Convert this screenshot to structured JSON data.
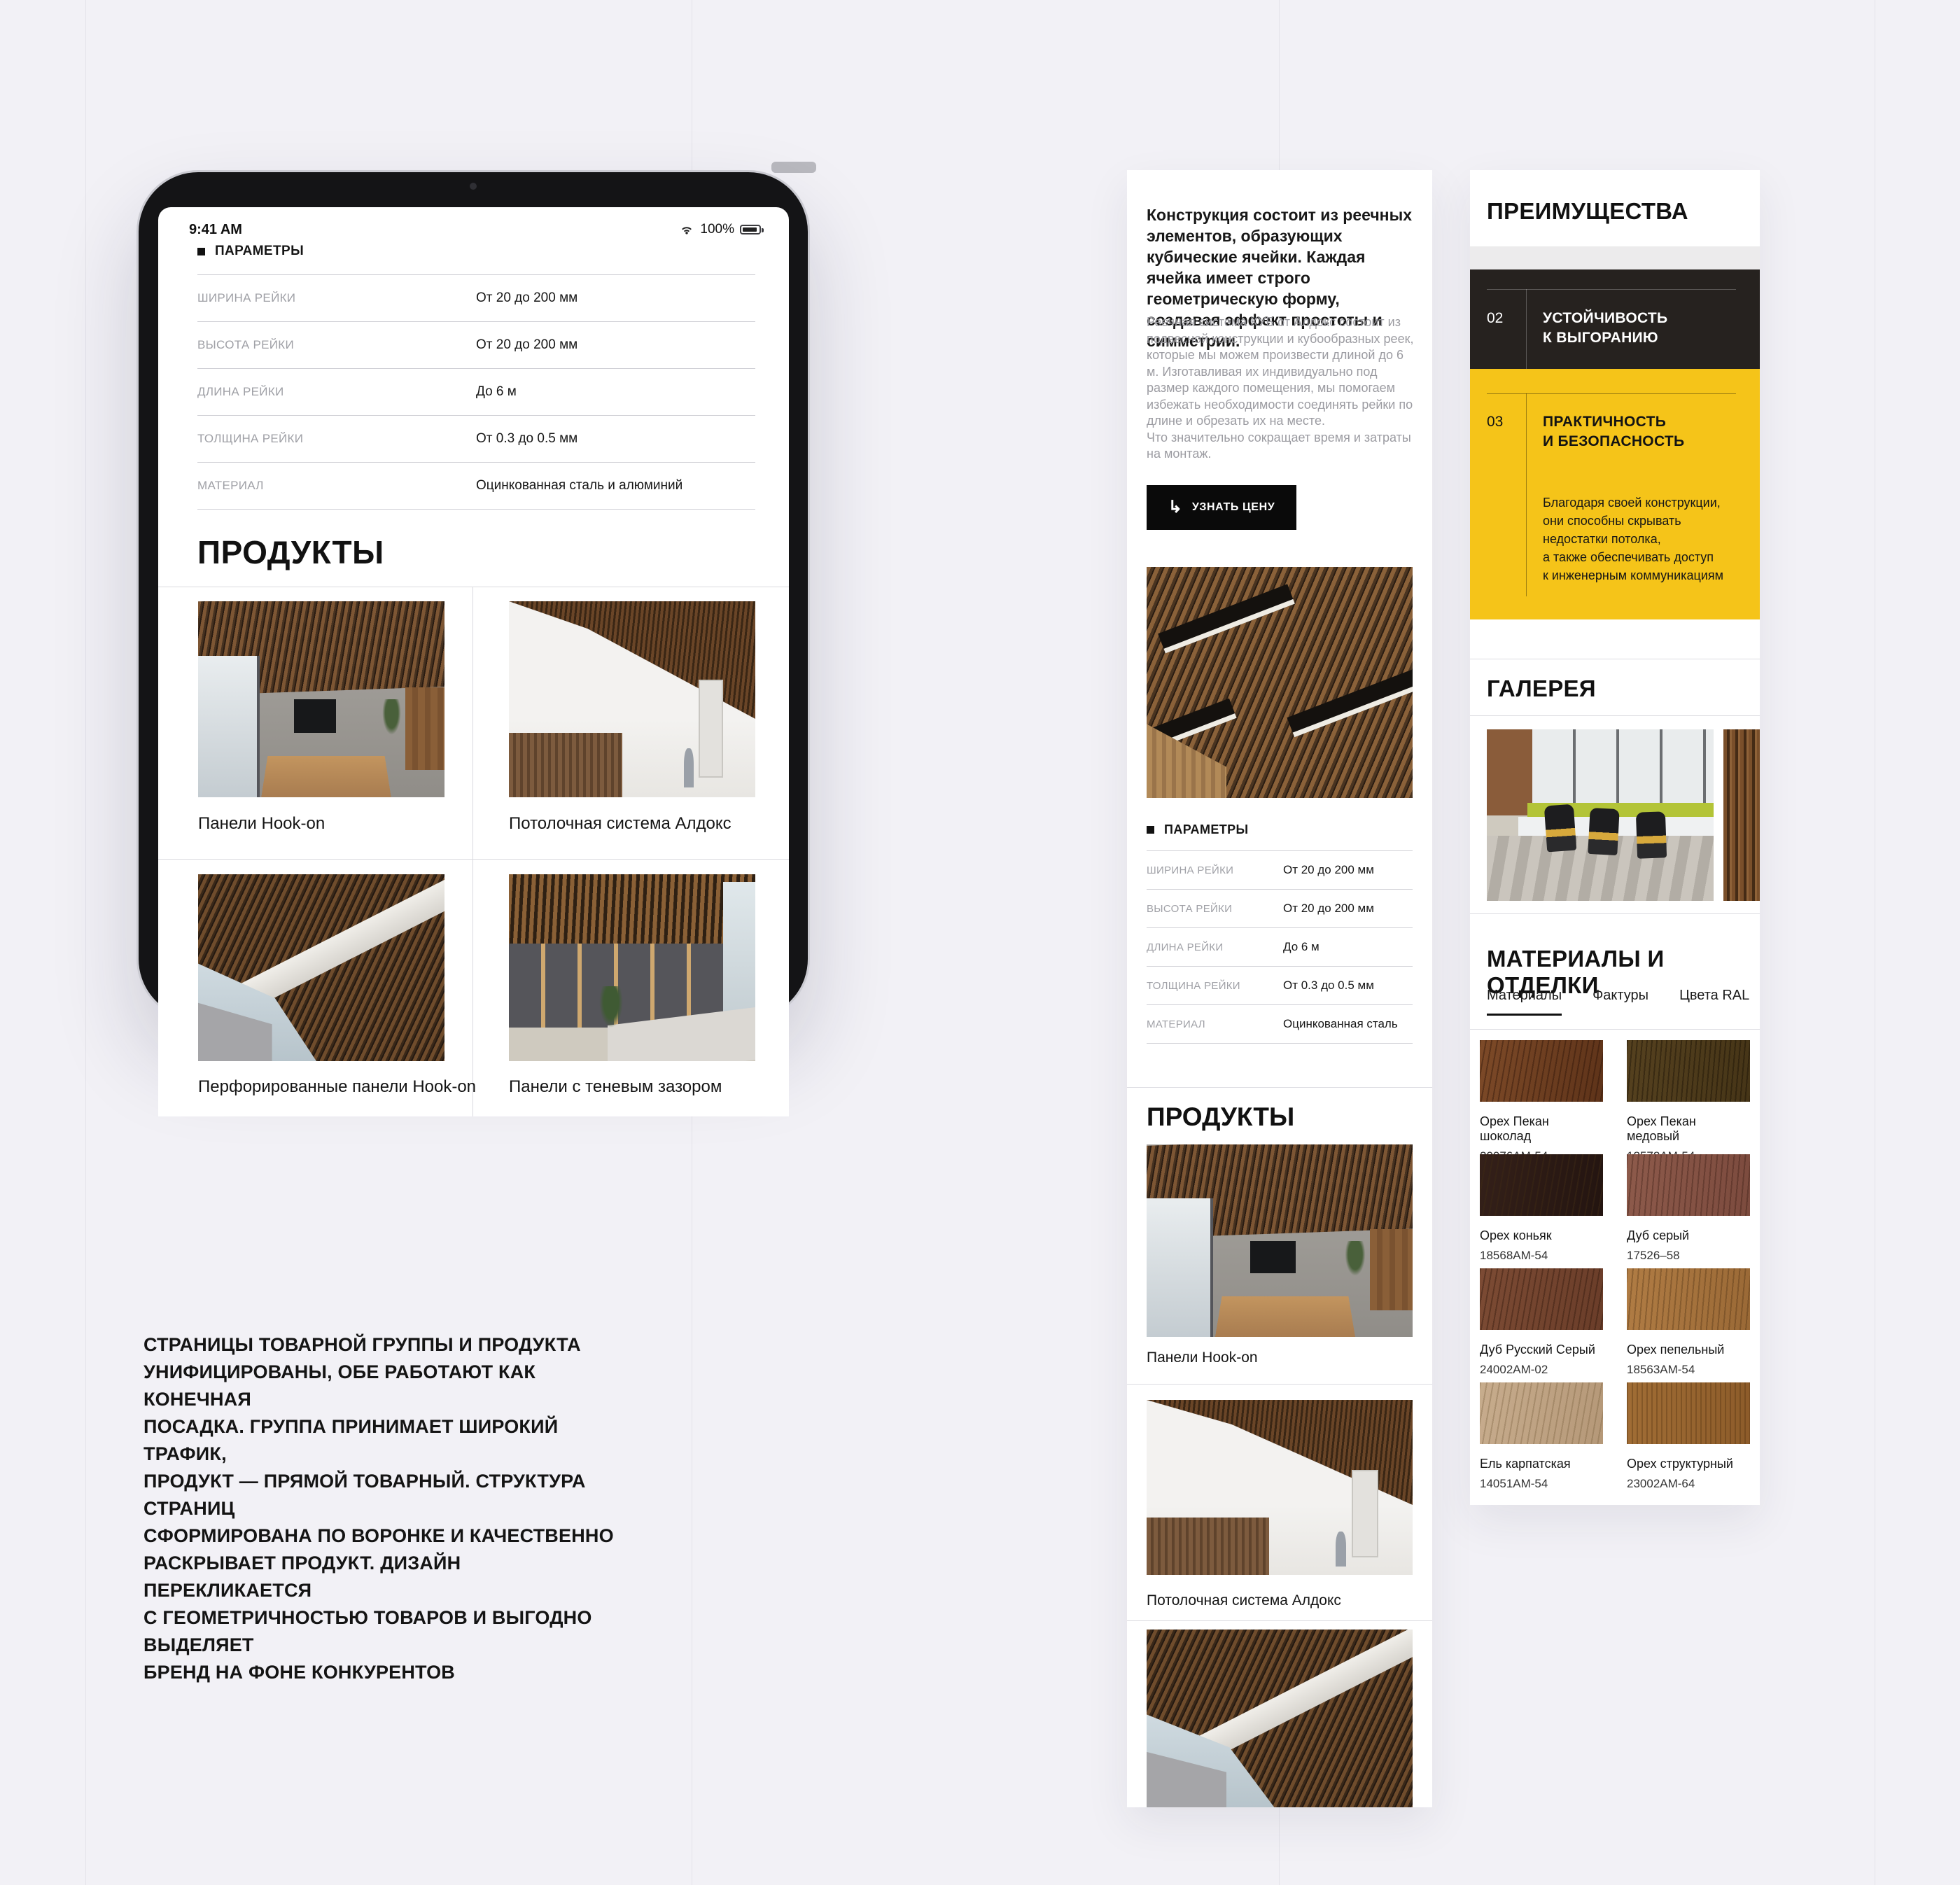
{
  "page": {
    "caption": "СТРАНИЦЫ ТОВАРНОЙ ГРУППЫ И ПРОДУКТА\nУНИФИЦИРОВАНЫ, ОБЕ РАБОТАЮТ КАК КОНЕЧНАЯ\nПОСАДКА. ГРУППА ПРИНИМАЕТ ШИРОКИЙ ТРАФИК,\nПРОДУКТ — ПРЯМОЙ ТОВАРНЫЙ. СТРУКТУРА СТРАНИЦ\nСФОРМИРОВАНА ПО ВОРОНКЕ И КАЧЕСТВЕННО\nРАСКРЫВАЕТ ПРОДУКТ. ДИЗАЙН ПЕРЕКЛИКАЕТСЯ\nС ГЕОМЕТРИЧНОСТЬЮ ТОВАРОВ И ВЫГОДНО ВЫДЕЛЯЕТ\nБРЕНД НА ФОНЕ КОНКУРЕНТОВ"
  },
  "tablet": {
    "status_time": "9:41 AM",
    "status_battery": "100%",
    "params_header": "ПАРАМЕТРЫ",
    "params_rows": [
      {
        "label": "ШИРИНА РЕЙКИ",
        "value": "От 20 до 200 мм"
      },
      {
        "label": "ВЫСОТА РЕЙКИ",
        "value": "От 20 до 200 мм"
      },
      {
        "label": "ДЛИНА РЕЙКИ",
        "value": "До 6 м"
      },
      {
        "label": "ТОЛЩИНА РЕЙКИ",
        "value": "От 0.3 до 0.5 мм"
      },
      {
        "label": "МАТЕРИАЛ",
        "value": "Оцинкованная сталь и алюминий"
      }
    ],
    "products_title": "ПРОДУКТЫ",
    "products": [
      {
        "label": "Панели Hook-on"
      },
      {
        "label": "Потолочная система Алдокс"
      },
      {
        "label": "Перфорированные панели Hook-on"
      },
      {
        "label": "Панели с теневым зазором"
      }
    ]
  },
  "mobile": {
    "intro": "Конструкция состоит из реечных элементов, образующих кубические ячейки. Каждая ячейка имеет строго геометрическую форму, создавая эффект простоты и симметрии.",
    "body": "Реечная система КУБ от Алдокс состоит из подвесной конструкции и кубообразных реек, которые мы можем произвести длиной до 6 м. Изготавливая их индивидуально под размер каждого помещения, мы помогаем избежать необходимости соединять рейки по длине и обрезать их на месте.\nЧто значительно сокращает время и затраты на монтаж.",
    "cta_label": "УЗНАТЬ ЦЕНУ",
    "cta_arrow": "↳",
    "params_header": "ПАРАМЕТРЫ",
    "params_rows": [
      {
        "label": "ШИРИНА РЕЙКИ",
        "value": "От 20 до 200 мм"
      },
      {
        "label": "ВЫСОТА РЕЙКИ",
        "value": "От 20 до 200 мм"
      },
      {
        "label": "ДЛИНА РЕЙКИ",
        "value": "До 6 м"
      },
      {
        "label": "ТОЛЩИНА РЕЙКИ",
        "value": "От 0.3 до 0.5 мм"
      },
      {
        "label": "МАТЕРИАЛ",
        "value": "Оцинкованная сталь"
      }
    ],
    "products_title": "ПРОДУКТЫ",
    "products": [
      {
        "label": "Панели Hook-on"
      },
      {
        "label": "Потолочная система Алдокс"
      }
    ]
  },
  "panel": {
    "advantages_title": "ПРЕИМУЩЕСТВА",
    "advantages": [
      {
        "num": "02",
        "title": "УСТОЙЧИВОСТЬ\nК ВЫГОРАНИЮ"
      },
      {
        "num": "03",
        "title": "ПРАКТИЧНОСТЬ\nИ БЕЗОПАСНОСТЬ",
        "text": "Благодаря своей конструкции,\nони способны скрывать\nнедостатки потолка,\nа также обеспечивать доступ\nк инженерным коммуникациям"
      }
    ],
    "gallery_title": "ГАЛЕРЕЯ",
    "materials_title": "МАТЕРИАЛЫ И ОТДЕЛКИ",
    "tabs": [
      {
        "label": "Материалы"
      },
      {
        "label": "Фактуры"
      },
      {
        "label": "Цвета RAL"
      }
    ],
    "swatches": [
      {
        "name": "Орех Пекан шоколад",
        "code": "20076AM-54"
      },
      {
        "name": "Орех Пекан медовый",
        "code": "18578AM-54"
      },
      {
        "name": "Орех коньяк",
        "code": "18568AM-54"
      },
      {
        "name": "Дуб серый",
        "code": "17526–58"
      },
      {
        "name": "Дуб Русский Серый",
        "code": "24002AM-02"
      },
      {
        "name": "Орех пепельный",
        "code": "18563AM-54"
      },
      {
        "name": "Ель карпатская",
        "code": "14051AM-54"
      },
      {
        "name": "Орех структурный",
        "code": "23002AM-64"
      }
    ]
  },
  "colors": {
    "accent_yellow": "#F5C419",
    "dark_block": "#26221F",
    "page_bg": "#F2F1F6"
  }
}
